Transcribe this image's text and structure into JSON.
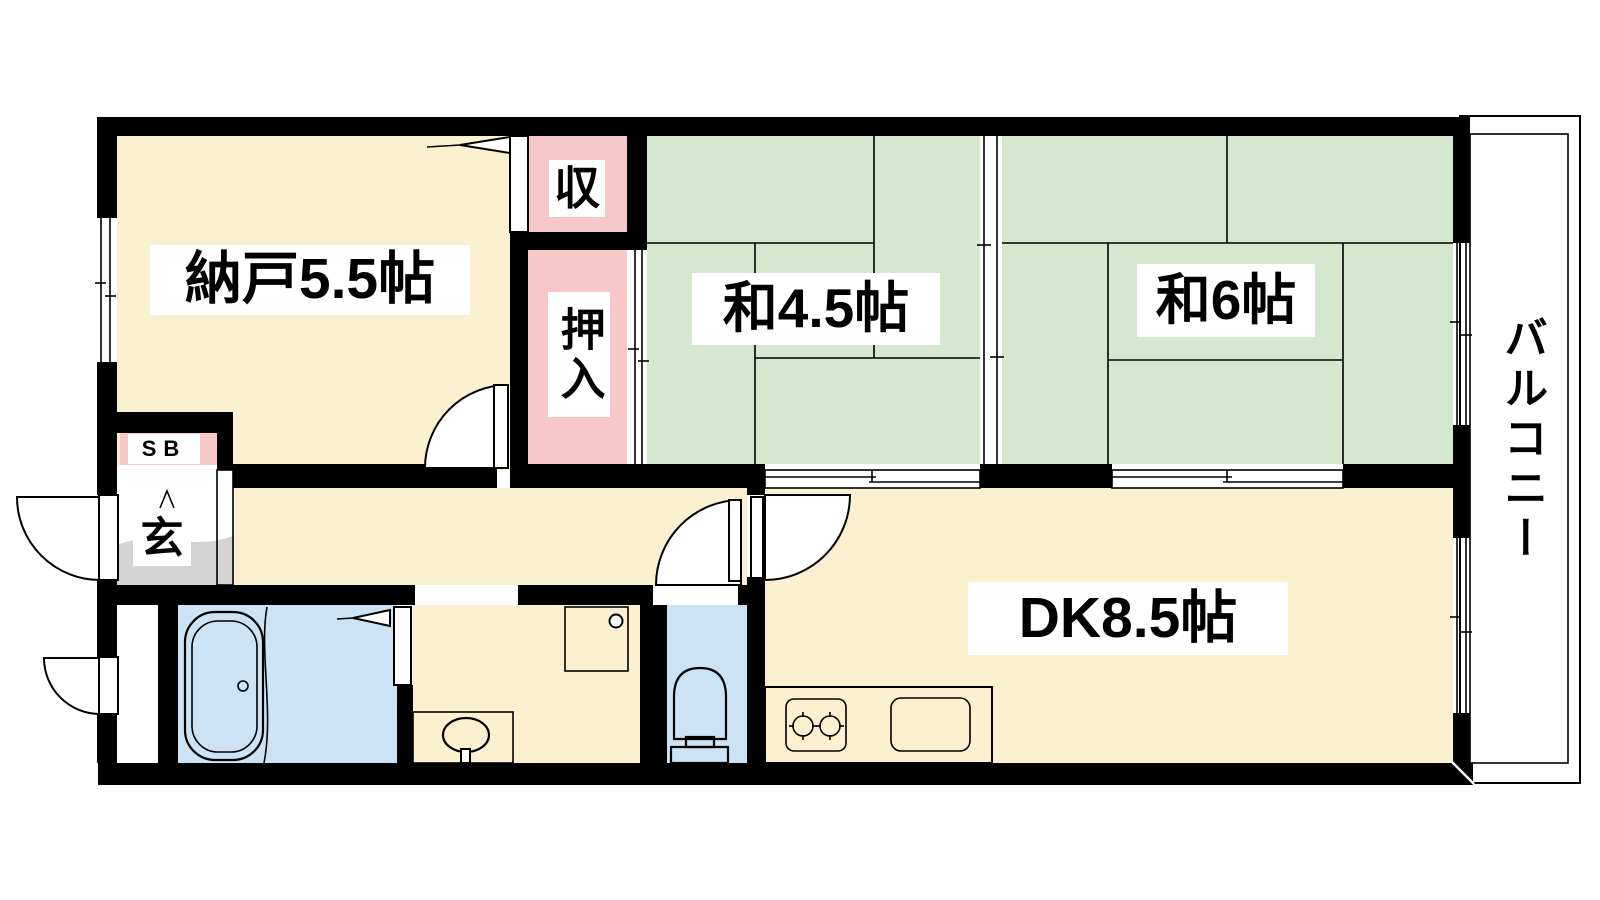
{
  "colors": {
    "wall": "#000000",
    "line": "#000000",
    "floor_cream": "#fbf1d0",
    "tatami_green": "#d5e7cc",
    "closet_pink": "#f8c8c8",
    "water_blue": "#cce2f5",
    "counter_lavender": "#e8dcf2",
    "concrete_gray": "#d4d4d4",
    "label_bg": "#ffffff"
  },
  "rooms": {
    "nando": {
      "label": "納戸5.5帖"
    },
    "washitsu45": {
      "label": "和4.5帖"
    },
    "washitsu6": {
      "label": "和6帖"
    },
    "dk": {
      "label": "DK8.5帖"
    },
    "shuno": {
      "label": "収"
    },
    "oshiire": {
      "label": "押入"
    },
    "shoebox": {
      "label": "SB"
    },
    "genkan": {
      "label": "玄"
    },
    "balcony": {
      "label": "バルコニー"
    }
  },
  "fixtures": [
    "bathtub",
    "washbasin",
    "washing-machine-pan",
    "toilet",
    "gas-stove",
    "kitchen-sink"
  ]
}
